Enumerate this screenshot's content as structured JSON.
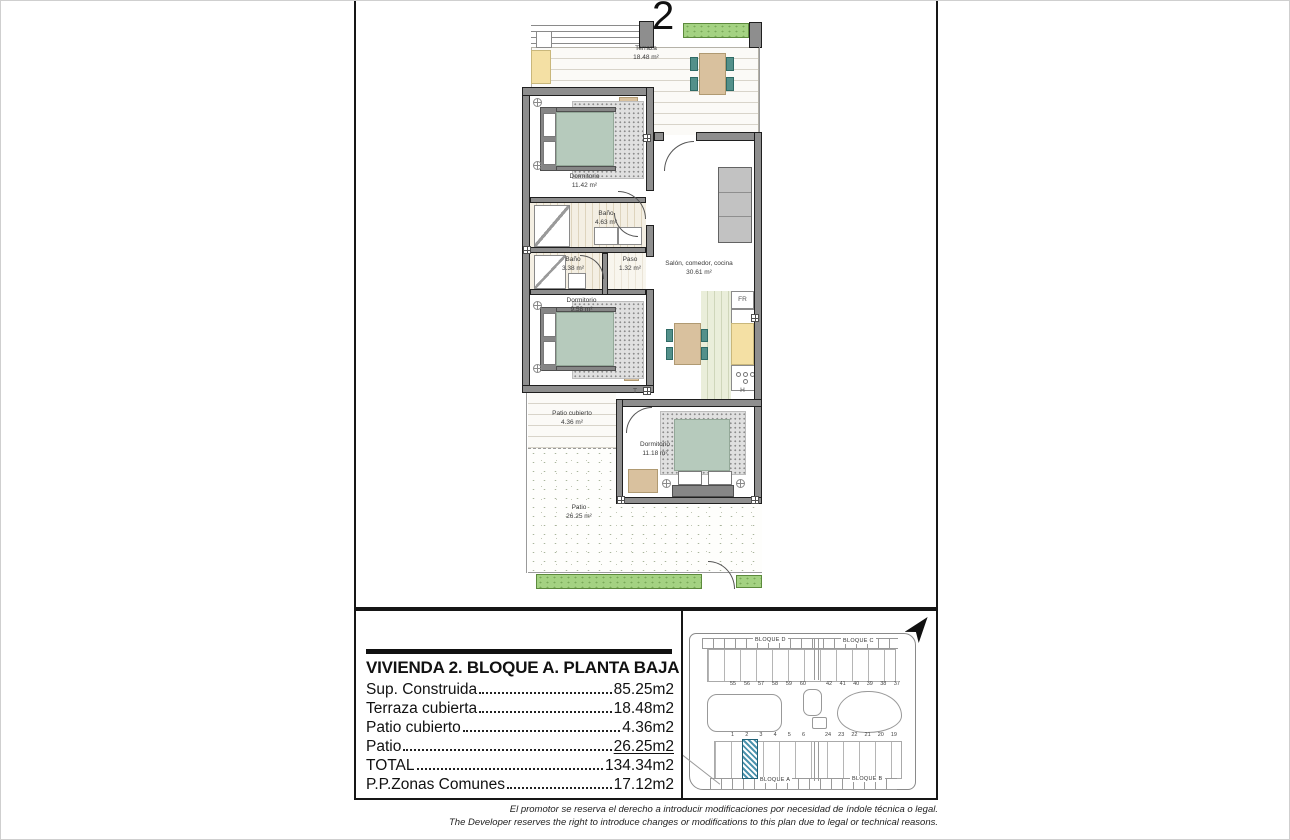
{
  "page": {
    "plan_number": "2",
    "disclaimer_es": "El promotor se reserva el derecho a introducir modificaciones por necesidad de índole técnica o legal.",
    "disclaimer_en": "The Developer reserves the right to introduce changes or modifications to this plan due to legal or technical reasons."
  },
  "floorplan": {
    "rooms": [
      {
        "name": "Terraza",
        "area": "18.48 m²"
      },
      {
        "name": "Dormitorio",
        "area": "11.42 m²"
      },
      {
        "name": "Baño",
        "area": "4.63 m²"
      },
      {
        "name": "Baño",
        "area": "3.38 m²"
      },
      {
        "name": "Paso",
        "area": "1.32 m²"
      },
      {
        "name": "Salón, comedor, cocina",
        "area": "30.61 m²"
      },
      {
        "name": "Dormitorio",
        "area": "9.58 m²"
      },
      {
        "name": "Patio cubierto",
        "area": "4.36 m²"
      },
      {
        "name": "Dormitorio",
        "area": "11.18 m²"
      },
      {
        "name": "Patio",
        "area": "26.25 m²"
      }
    ],
    "appliances": {
      "fridge": "FR",
      "toilet": "T",
      "hob": "H"
    }
  },
  "summary_table": {
    "title": "VIVIENDA 2. BLOQUE A. PLANTA BAJA",
    "rows": [
      {
        "label": "Sup. Construida",
        "value": "85.25m2"
      },
      {
        "label": "Terraza cubierta",
        "value": "18.48m2"
      },
      {
        "label": "Patio cubierto",
        "value": "4.36m2"
      },
      {
        "label": "Patio",
        "value": "26.25m2"
      },
      {
        "label": "TOTAL",
        "value": "134.34m2"
      },
      {
        "label": "P.P.Zonas Comunes",
        "value": "17.12m2"
      }
    ]
  },
  "siteplan": {
    "blocks": {
      "top_left": "BLOQUE D",
      "top_right": "BLOQUE C",
      "bottom_left": "BLOQUE A",
      "bottom_right": "BLOQUE B"
    },
    "top_numbers_left": [
      "55",
      "56",
      "57",
      "58",
      "59",
      "60"
    ],
    "top_numbers_right": [
      "42",
      "41",
      "40",
      "39",
      "38",
      "37"
    ],
    "bottom_numbers_left": [
      "1",
      "2",
      "3",
      "4",
      "5",
      "6"
    ],
    "bottom_numbers_right": [
      "24",
      "23",
      "22",
      "21",
      "20",
      "19"
    ],
    "highlighted_unit": "2"
  },
  "colors": {
    "duvet_sage": "#b6cabc",
    "furniture_tan": "#d9c19e",
    "chair_teal": "#53908a",
    "counter_yellow": "#f4e0a4",
    "hedge_green": "#a4d282",
    "highlight_blue": "#4c93ad",
    "wall_gray": "#8e8e8e"
  }
}
